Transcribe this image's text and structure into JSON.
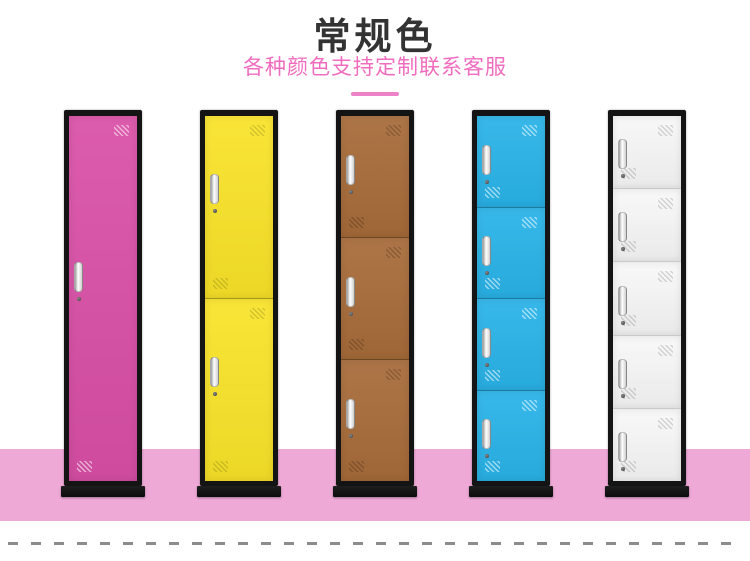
{
  "header": {
    "title": "常规色",
    "subtitle": "各种颜色支持定制联系客服"
  },
  "colors": {
    "background": "#ffffff",
    "title_text": "#333333",
    "subtitle_text": "#f06cbe",
    "underline": "#ee82c8",
    "floor": "#efa9d7",
    "locker_frame": "#141414",
    "dash": "#8c8c8c"
  },
  "lockers": [
    {
      "name": "locker-rose-1-door",
      "color": "#d94fa6",
      "doors": 1,
      "vent_stripe": "rgba(255,255,255,0.55)",
      "seam": "rgba(0,0,0,0.30)"
    },
    {
      "name": "locker-yellow-2-door",
      "color": "#f9e328",
      "doors": 2,
      "vent_stripe": "rgba(0,0,0,0.15)",
      "seam": "rgba(0,0,0,0.30)"
    },
    {
      "name": "locker-brown-3-door",
      "color": "#a76b39",
      "doors": 3,
      "vent_stripe": "rgba(0,0,0,0.20)",
      "seam": "rgba(0,0,0,0.30)"
    },
    {
      "name": "locker-blue-4-door",
      "color": "#29b3e8",
      "doors": 4,
      "vent_stripe": "rgba(255,255,255,0.55)",
      "seam": "rgba(0,0,0,0.28)"
    },
    {
      "name": "locker-white-5-door",
      "color": "#f7f7f7",
      "doors": 5,
      "vent_stripe": "rgba(0,0,0,0.15)",
      "seam": "rgba(0,0,0,0.14)"
    }
  ]
}
